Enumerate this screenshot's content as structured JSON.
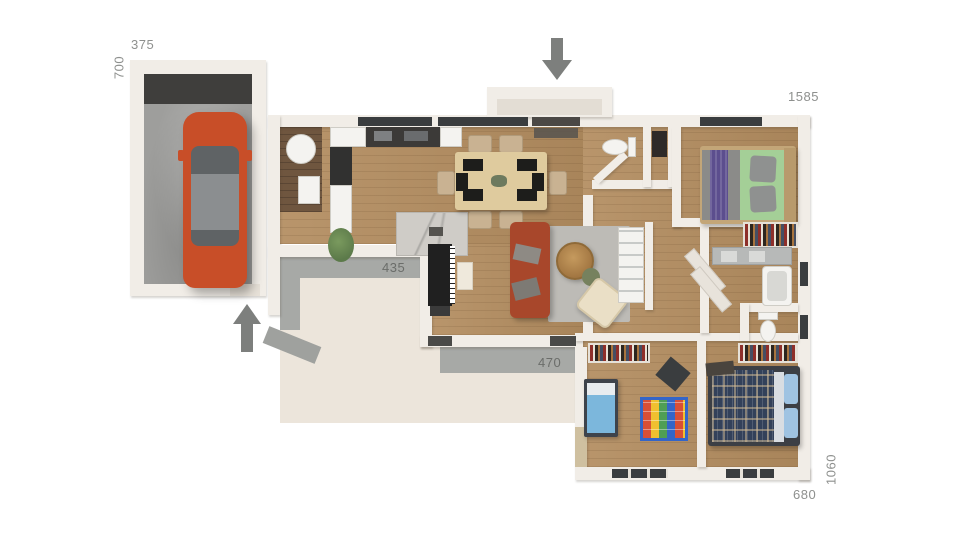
{
  "title": "3d-house-floor-plan",
  "dimensions": {
    "garage_width": "375",
    "garage_depth": "700",
    "house_top_width": "1585",
    "terrace_side": "435",
    "terrace_bottom": "470",
    "wing_bottom_width": "680",
    "wing_right_depth": "1060"
  },
  "icons": {
    "entry_arrow": "arrow-down",
    "garage_side_entry_arrow": "arrow-up"
  },
  "colors": {
    "bg": "#ffffff",
    "wall": "#f1ede7",
    "wood": "#b38d60",
    "wood_dark": "#6f563f",
    "terrace": "#ece5db",
    "concrete": "#9e9e9c",
    "concrete_dark": "#3f3e3c",
    "band_gray": "#a7a9a6",
    "car_orange": "#c84e28",
    "car_glass": "#5f6365",
    "car_roof": "#8b8e90",
    "sofa_terracotta": "#a8472b",
    "rug_gray": "#bdbbb6",
    "chair_cream": "#eadfc6",
    "table_wood": "#dfcb9e",
    "chair_tan": "#c9b292",
    "marble": "#cfccc7",
    "counter_dark": "#3c3a38",
    "bed_frame_tan": "#c3a678",
    "bed_gray": "#8b8b89",
    "bed_purple": "#5c4e8e",
    "bed_green": "#a4cf97",
    "kids_blue": "#7cb7dc",
    "plaid_navy": "#33415a",
    "pillow_blue": "#9fc3e2",
    "closet_dark": "#241d17",
    "fixture_white": "#f4f3f0",
    "window_dark": "#3a3d3f",
    "arrow_gray": "#7d7f7d",
    "label_gray": "#8e908e",
    "plant_green": "#5c7a4a"
  }
}
